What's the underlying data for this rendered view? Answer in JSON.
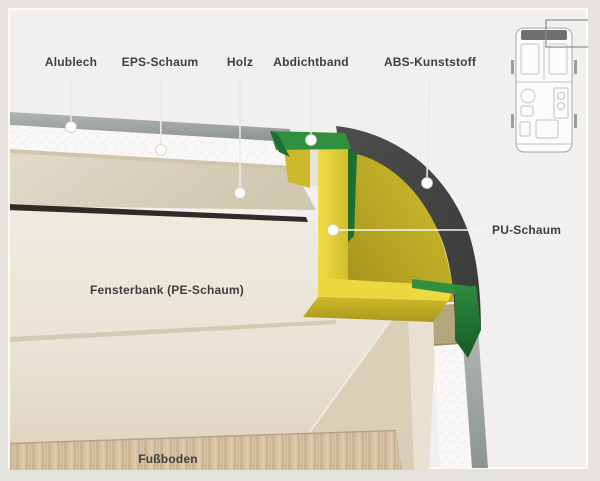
{
  "diagram": {
    "type": "caravan-wall-corner-cutaway",
    "labels": {
      "alublech": "Alublech",
      "eps_schaum": "EPS-Schaum",
      "holz": "Holz",
      "abdichtband": "Abdichtband",
      "abs_kunststoff": "ABS-Kunststoff",
      "pu_schaum": "PU-Schaum",
      "fensterbank": "Fensterbank (PE-Schaum)",
      "fussboden": "Fußboden"
    }
  },
  "icons": {
    "floorplan": "caravan-floorplan-icon",
    "floorplan_highlight": "front-right-corner-highlight-box"
  },
  "colors": {
    "background_outer": "#e6e2dd",
    "background_inner": "#f1f0ee",
    "frame_border": "#fbfaf9",
    "label_text": "#3e3e3e",
    "aluminum": "#9ba09d",
    "eps_foam": "#f9f8f7",
    "wood_edge": "#cfc5ab",
    "wood_ceiling": "#ddd5c2",
    "shadow_gap": "#2e2c28",
    "interior_wall": "#ece7db",
    "sill_edge": "#cfc5ae",
    "under_sill": "#dccfb8",
    "floor_wood": "#d6c2a5",
    "wall_base": "#d9cdb6",
    "wall_panel": "#e8e1d2",
    "wood_block": "#b3a67c",
    "abs_plastic": "#434543",
    "pu_fill": "#c8b527",
    "pu_bracket_top": "#ecd93f",
    "pu_bracket_block": "#cdba2c",
    "pale_strip": "#e8e4d8",
    "tape_green": "#2f9140",
    "tape_green_dark": "#1e6e30",
    "leader_line": "#e9e9e6",
    "leader_dot": "#fdfdfc",
    "floorplan_line": "#b6b6b4",
    "floorplan_cab": "#6f716f"
  }
}
